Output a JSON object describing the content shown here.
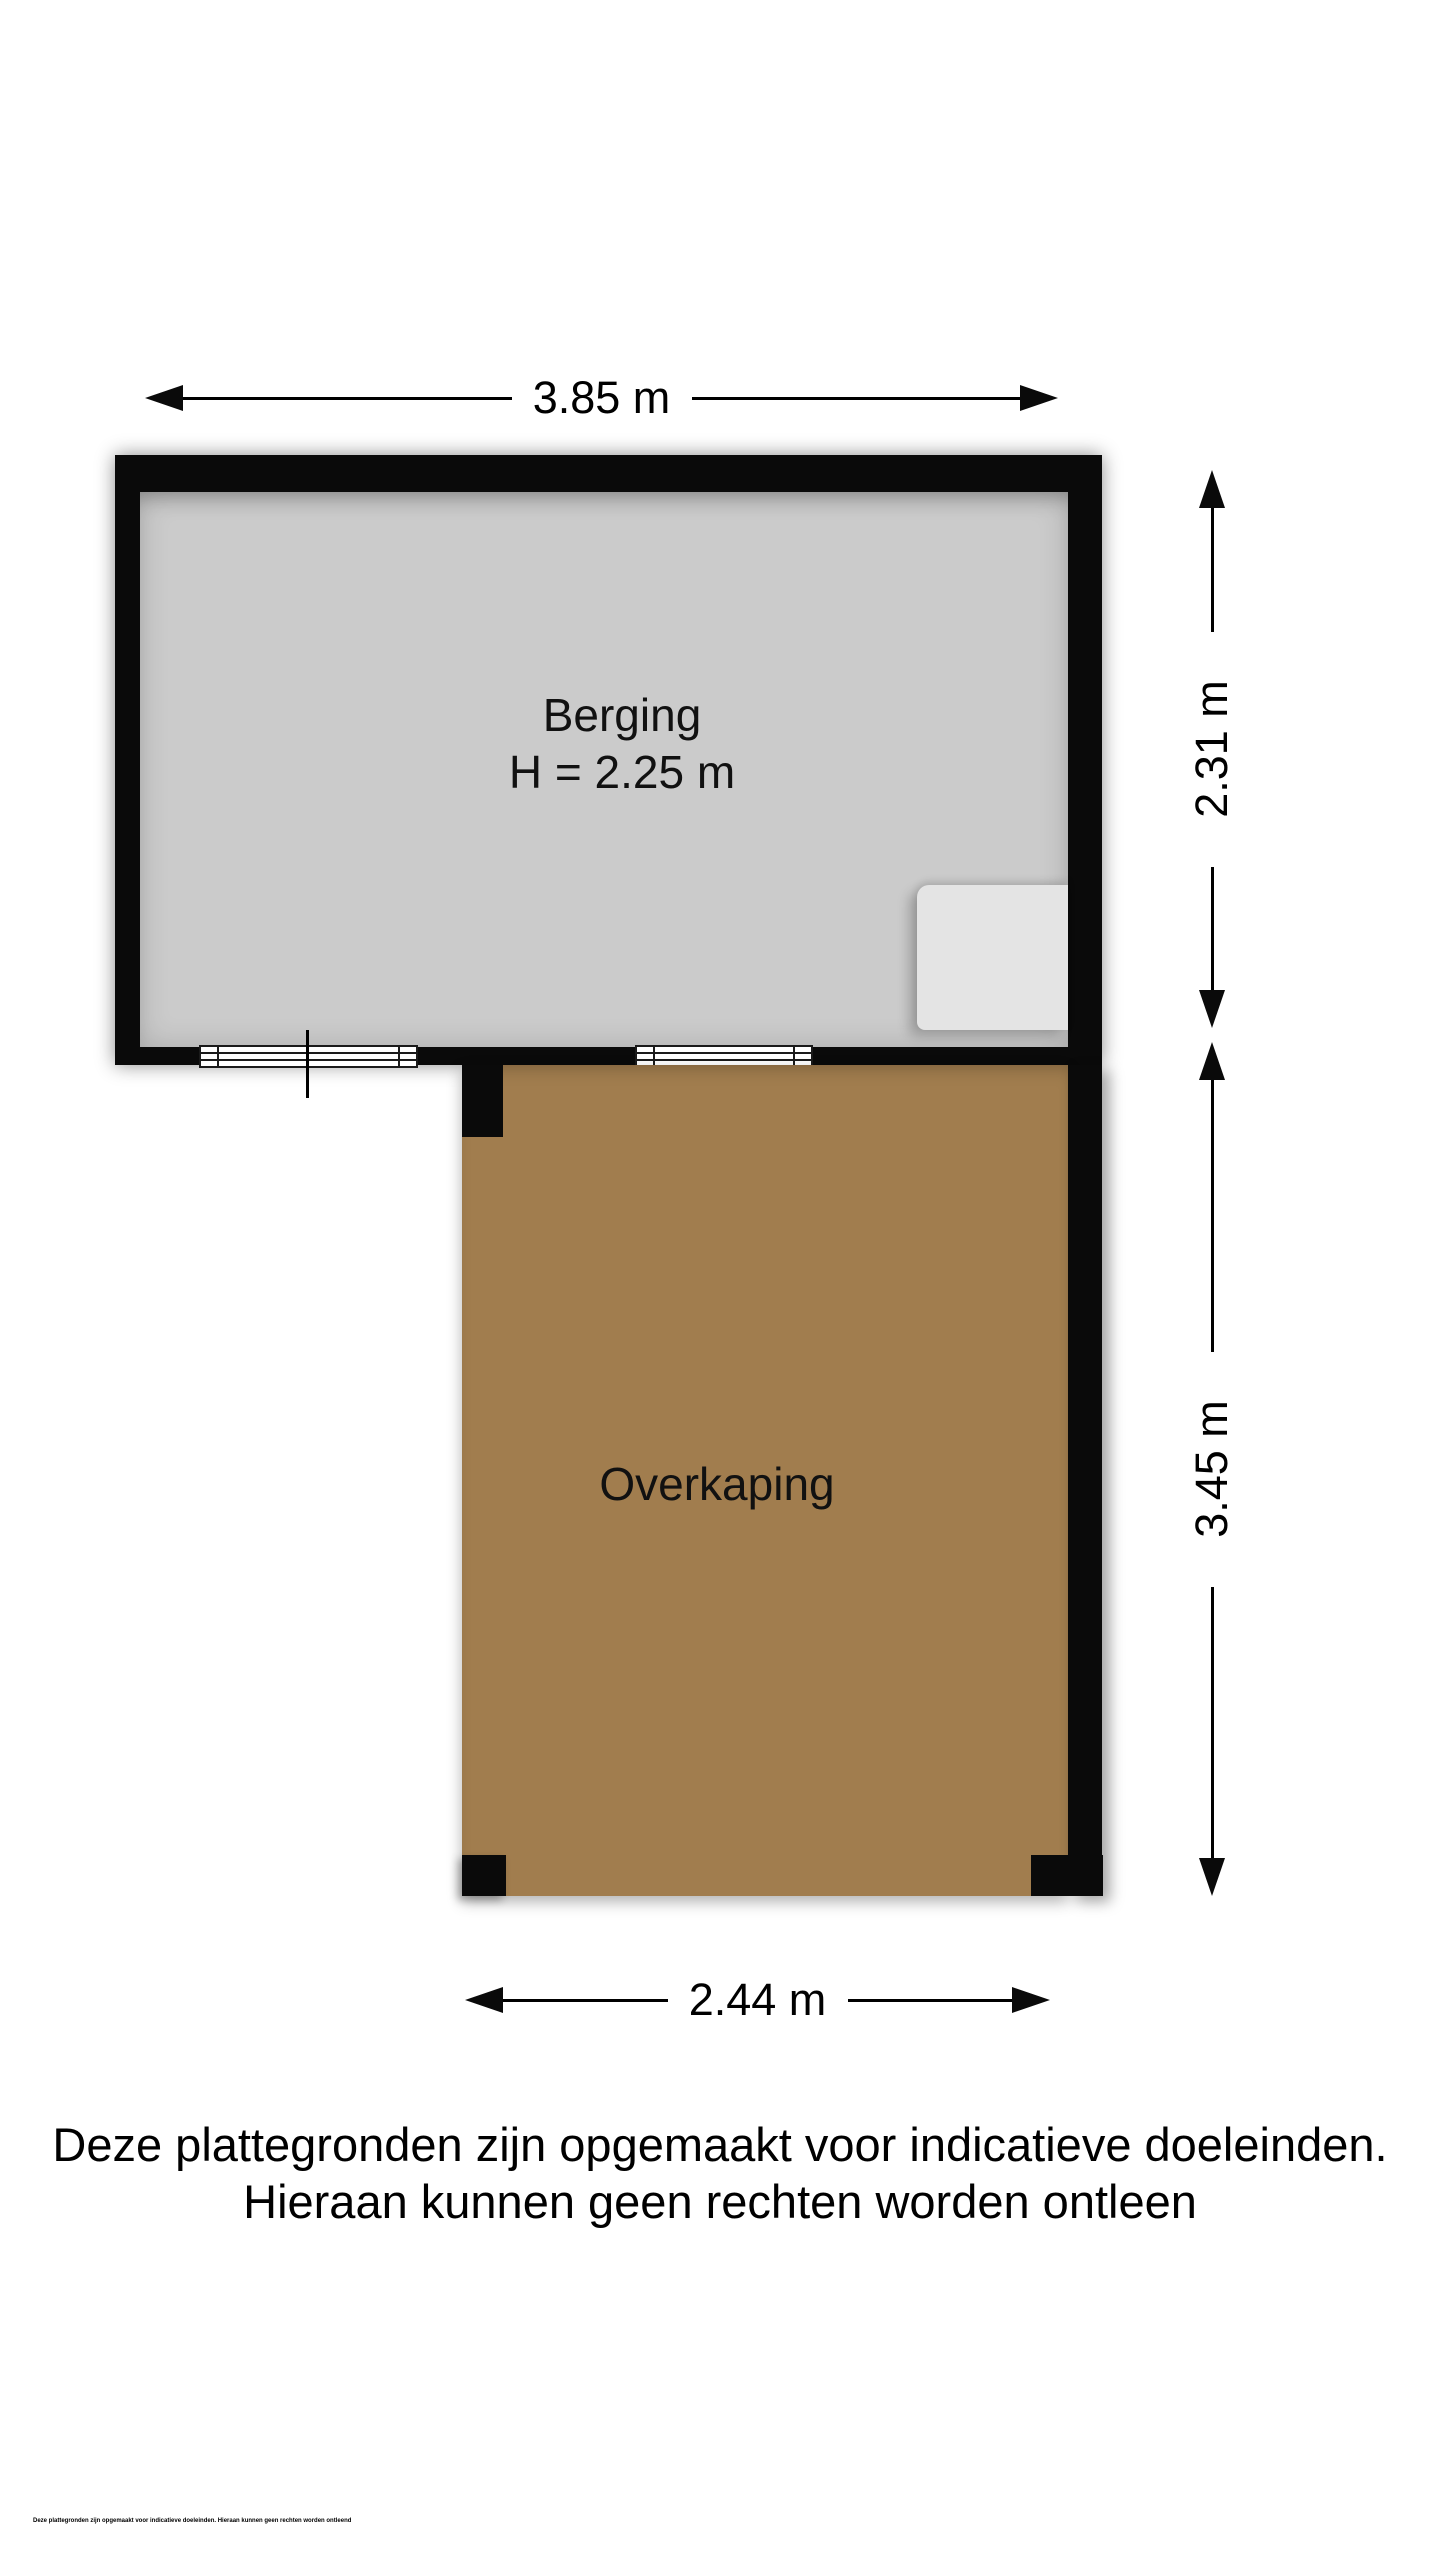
{
  "floorplan": {
    "rooms": [
      {
        "name": "Berging",
        "height_label": "H = 2.25 m"
      },
      {
        "name": "Overkaping"
      }
    ],
    "dimensions": {
      "top_width": "3.85 m",
      "berging_depth": "2.31 m",
      "overkaping_depth": "3.45 m",
      "overkaping_width": "2.44 m"
    },
    "disclaimer_line1": "Deze plattegronden zijn opgemaakt voor indicatieve doeleinden.",
    "disclaimer_line2": "Hieraan kunnen geen rechten worden ontleen",
    "fine_print": "Deze plattegronden zijn opgemaakt voor indicatieve doeleinden. Hieraan kunnen geen rechten worden ontleend",
    "colors": {
      "wall": "#0a0a0a",
      "berging_floor": "#cbcbcb",
      "overkaping_floor": "#a17d4e",
      "closet": "#e4e4e4",
      "background": "#ffffff"
    }
  }
}
